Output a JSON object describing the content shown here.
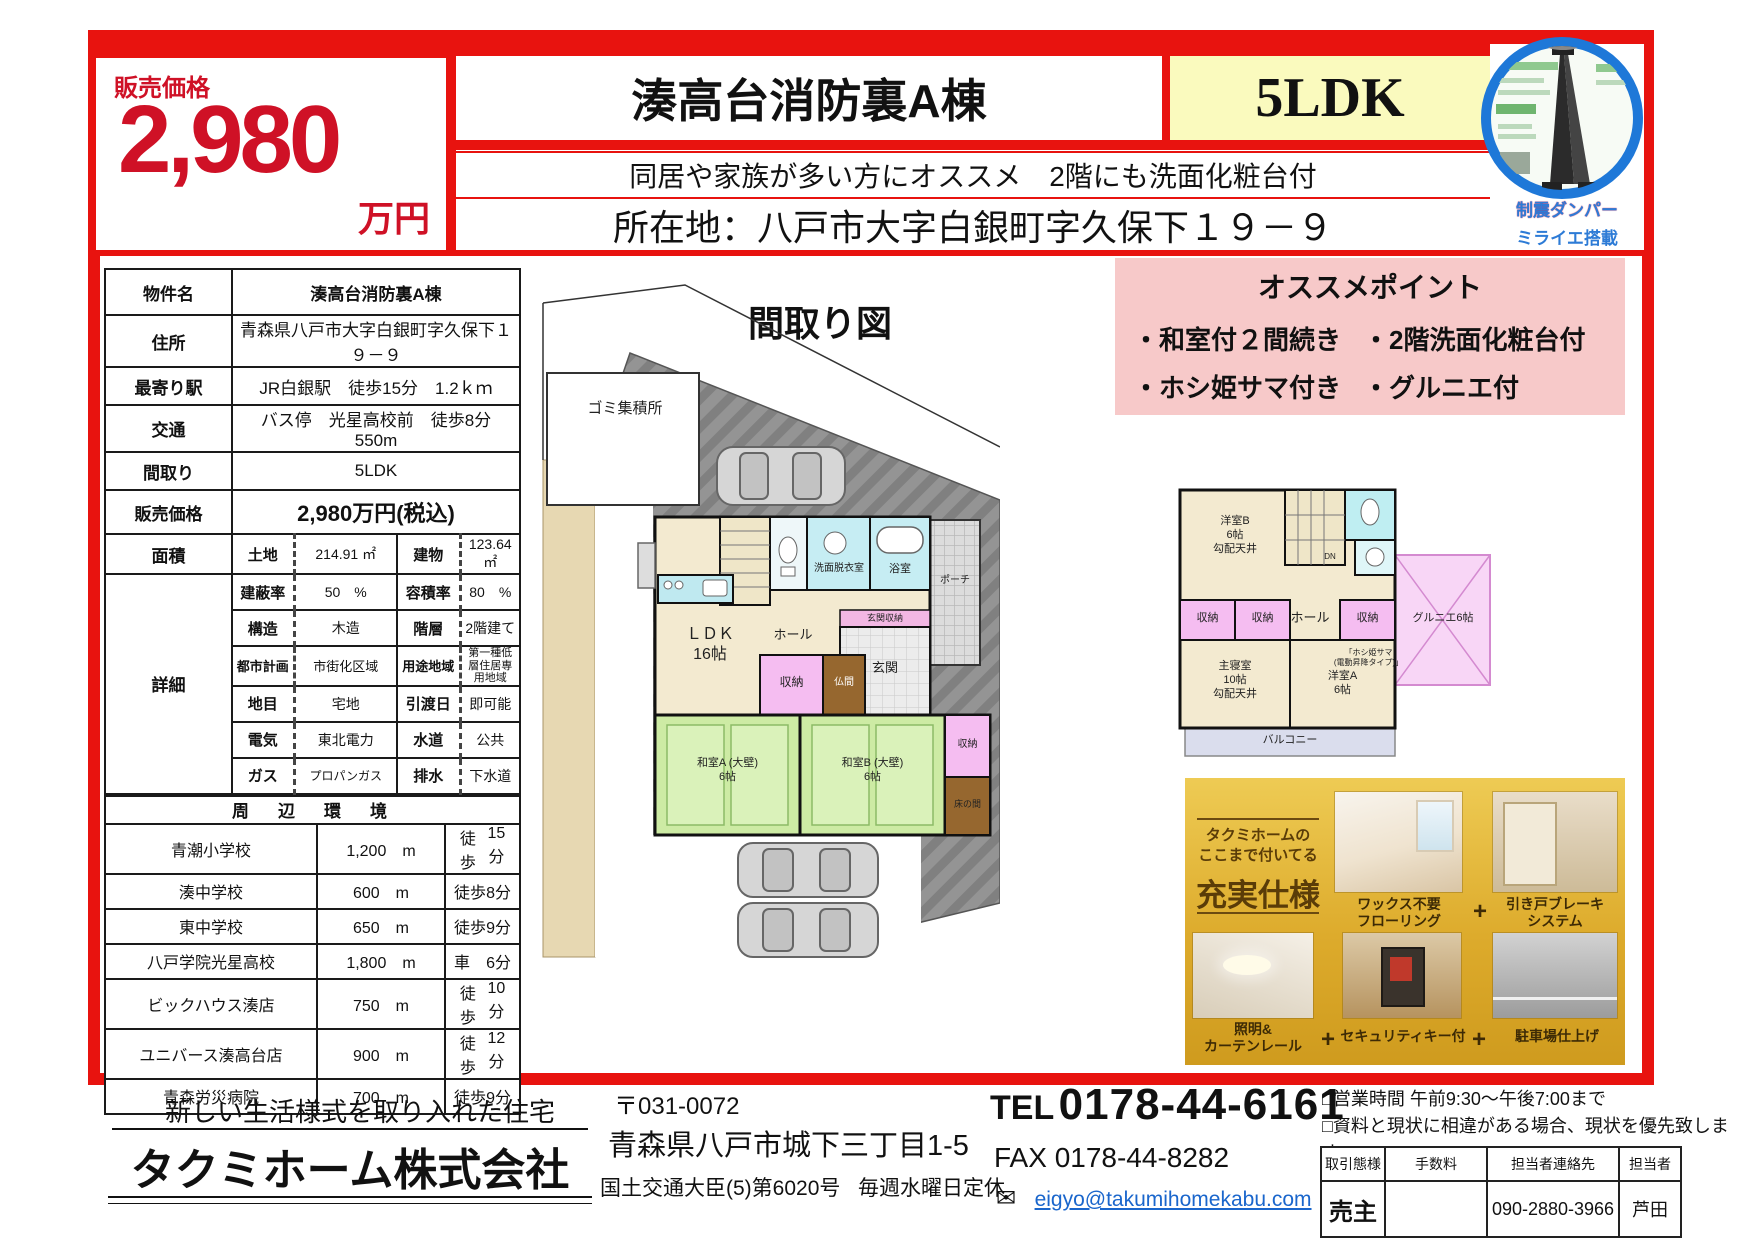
{
  "header": {
    "price_label": "販売価格",
    "price_value": "2,980",
    "price_unit": "万円",
    "title": "湊高台消防裏A棟",
    "layout": "5LDK",
    "subtitle": "同居や家族が多い方にオススメ　2階にも洗面化粧台付",
    "address": "所在地：八戸市大字白銀町字久保下１９－９",
    "damper_badge": {
      "line1": "制震ダンパー",
      "line2": "ミライエ搭載"
    }
  },
  "property_table": {
    "rows": [
      {
        "label": "物件名",
        "value": "湊高台消防裏A棟"
      },
      {
        "label": "住所",
        "value": "青森県八戸市大字白銀町字久保下１９－９"
      },
      {
        "label": "最寄り駅",
        "value": "JR白銀駅　徒歩15分　1.2ｋｍ"
      },
      {
        "label": "交通",
        "value": "バス停　光星高校前　徒歩8分　550m"
      },
      {
        "label": "間取り",
        "value": "5LDK"
      },
      {
        "label": "販売価格",
        "value": "2,980万円(税込)"
      }
    ],
    "area": {
      "label": "面積",
      "c1": "土地",
      "v1": "214.91 ㎡",
      "c2": "建物",
      "v2": "123.64 ㎡"
    },
    "detail": {
      "label": "詳細",
      "rows": [
        {
          "c1": "建蔽率",
          "v1": "50　%",
          "c2": "容積率",
          "v2": "80　%"
        },
        {
          "c1": "構造",
          "v1": "木造",
          "c2": "階層",
          "v2": "2階建て"
        },
        {
          "c1": "都市計画",
          "v1": "市街化区域",
          "c2": "用途地域",
          "v2": "第一種低層住居専用地域"
        },
        {
          "c1": "地目",
          "v1": "宅地",
          "c2": "引渡日",
          "v2": "即可能"
        },
        {
          "c1": "電気",
          "v1": "東北電力",
          "c2": "水道",
          "v2": "公共"
        },
        {
          "c1": "ガス",
          "v1": "プロパンガス",
          "c2": "排水",
          "v2": "下水道"
        }
      ]
    },
    "env": {
      "header": "周　辺　環　境",
      "rows": [
        {
          "name": "青潮小学校",
          "dist": "1,200　m",
          "mode": "徒歩",
          "time": "15分"
        },
        {
          "name": "湊中学校",
          "dist": "600　m",
          "mode": "徒歩",
          "time": "8分"
        },
        {
          "name": "東中学校",
          "dist": "650　m",
          "mode": "徒歩",
          "time": "9分"
        },
        {
          "name": "八戸学院光星高校",
          "dist": "1,800　m",
          "mode": "車",
          "time": "6分"
        },
        {
          "name": "ビックハウス湊店",
          "dist": "750　m",
          "mode": "徒歩",
          "time": "10分"
        },
        {
          "name": "ユニバース湊高台店",
          "dist": "900　m",
          "mode": "徒歩",
          "time": "12分"
        },
        {
          "name": "青森労災病院",
          "dist": "700　m",
          "mode": "徒歩",
          "time": "9分"
        }
      ]
    }
  },
  "floorplan": {
    "title": "間取り図",
    "site": {
      "trash": "ゴミ集積所"
    },
    "f1": {
      "ldk": "ＬＤＫ\n16帖",
      "senmen": "洗面脱衣室",
      "bath": "浴室",
      "porch": "ポーチ",
      "genkan_shuno": "玄関収納",
      "genkan": "玄関",
      "hall": "ホール",
      "shuno": "収納",
      "butsuma": "仏間",
      "washitsu_a": "和室A (大壁)\n6帖",
      "washitsu_b": "和室B (大壁)\n6帖",
      "shuno2": "収納",
      "tokonoma": "床の間"
    },
    "f2": {
      "yoshitsu_b": "洋室B\n6帖\n勾配天井",
      "dn": "DN",
      "hall": "ホール",
      "hoshi_note": "「ホシ姫サマ\n(電動昇降タイプ)」",
      "shuno1": "収納",
      "shuno2": "収納",
      "shuno3": "収納",
      "shinshitsu": "主寝室\n10帖\n勾配天井",
      "yoshitsu_a": "洋室A\n6帖",
      "gurunie": "グルニエ6帖",
      "balcony": "バルコニー"
    }
  },
  "points": {
    "title": "オススメポイント",
    "items": [
      "・和室付２間続き",
      "・2階洗面化粧台付",
      "・ホシ姫サマ付き",
      "・グルニエ付"
    ]
  },
  "spec_panel": {
    "heading_small": "タクミホームの\nここまで付いてる",
    "heading_big": "充実仕様",
    "plus": "+",
    "features": [
      "ワックス不要\nフローリング",
      "引き戸ブレーキ\nシステム",
      "照明&\nカーテンレール",
      "セキュリティキー付",
      "駐車場仕上げ"
    ]
  },
  "footer": {
    "tagline": "新しい生活様式を取り入れた住宅",
    "company": "タクミホーム株式会社",
    "postal": "〒031-0072",
    "address": "青森県八戸市城下三丁目1-5",
    "license": "国土交通大臣(5)第6020号",
    "holiday": "毎週水曜日定休",
    "tel_label": "TEL",
    "tel_number": "0178-44-6161",
    "fax": "FAX 0178-44-8282",
    "email": "eigyo@takumihomekabu.com",
    "notes": [
      "□営業時間 午前9:30～午後7:00まで",
      "□資料と現状に相違がある場合、現状を優先致します。"
    ],
    "deal_table": {
      "headers": [
        "取引態様",
        "手数料",
        "担当者連絡先",
        "担当者"
      ],
      "row": [
        "売主",
        "",
        "090-2880-3966",
        "芦田"
      ]
    }
  },
  "colors": {
    "accent_red": "#e8130f",
    "price_red": "#cf1126",
    "pink": "#f7c9c9",
    "pale_yellow": "#fafabe",
    "link_blue": "#1a66cc",
    "badge_blue": "#2d7bd6"
  }
}
